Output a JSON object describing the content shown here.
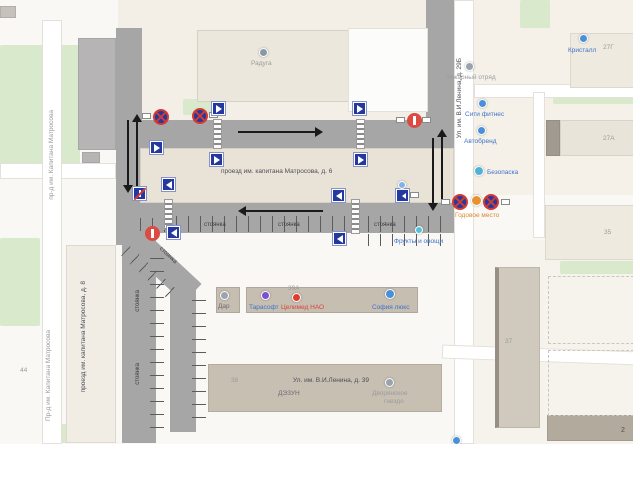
{
  "labels": {
    "parking": "стоянка",
    "building_6": "проезд им. капитана Матросова, д. 6",
    "building_8": "проезд им. капитана Матросова, д. 8",
    "street_matrosova_top": "пр-д им. Капитана Матросова",
    "street_matrosova_bottom": "Пр-д им. Капитана Матросова",
    "street_lenina_29": "Ул. им. В.И.Ленина, д. 29Б",
    "street_lenina_39": "Ул. им. В.И.Ленина, д. 39",
    "num_27g": "27Г",
    "num_27a": "27А",
    "num_35": "35",
    "num_37": "37",
    "num_38": "38",
    "num_39a": "39А",
    "num_2": "2",
    "num_44": "44"
  },
  "pois": {
    "raduga": "Радуга",
    "kristall": "Кристалл",
    "fire_station": "пожарный отряд",
    "city_fitness": "Сити фитнес",
    "avtobrend": "Автобренд",
    "bezopaska": "Безопаска",
    "godovoe_mesto": "Годовое место",
    "fruits": "Фрукты и овощи",
    "dar": "Дар",
    "tarasoft": "Тарасофт",
    "celimed": "Целимед НАО",
    "sofia": "София люкс",
    "dezun": "ДЭЗУН",
    "dvoryanskoe_1": "Дворянское",
    "dvoryanskoe_2": "гнездо"
  },
  "icons": {
    "no-stopping-sign": "blue circle with red ring and red X",
    "no-entry-sign": "red circle with white bar",
    "pedestrian-crossing-sign": "blue square with white triangle",
    "one-way-end-sign": "blue square with white arrow and red slash",
    "one-way-left-sign": "blue square with white left arrow",
    "sign-plate": "small white rectangular plate",
    "direction-arrow": "black arrow on road",
    "crosswalk": "zebra-stripe ladder",
    "poi-marker": "colored circle marker"
  },
  "colors": {
    "road": "#a6a6a6",
    "building_light": "#ece7dc",
    "building_tan": "#c6beb1",
    "building_grey": "#b7b4b5",
    "green": "#d9e9cc",
    "sign_blue": "#24399f",
    "sign_red": "#d23a34",
    "poi_blue": "#4a90d9",
    "poi_red": "#e23c30",
    "poi_purple": "#7a4fd1",
    "poi_orange": "#e8922f",
    "label_grey": "#9b9b9b",
    "label_dark": "#4c4c58",
    "label_blue": "#3f72c8",
    "label_red": "#d8453a",
    "label_orange": "#d9882e",
    "arrow_black": "#1a1a1a"
  }
}
